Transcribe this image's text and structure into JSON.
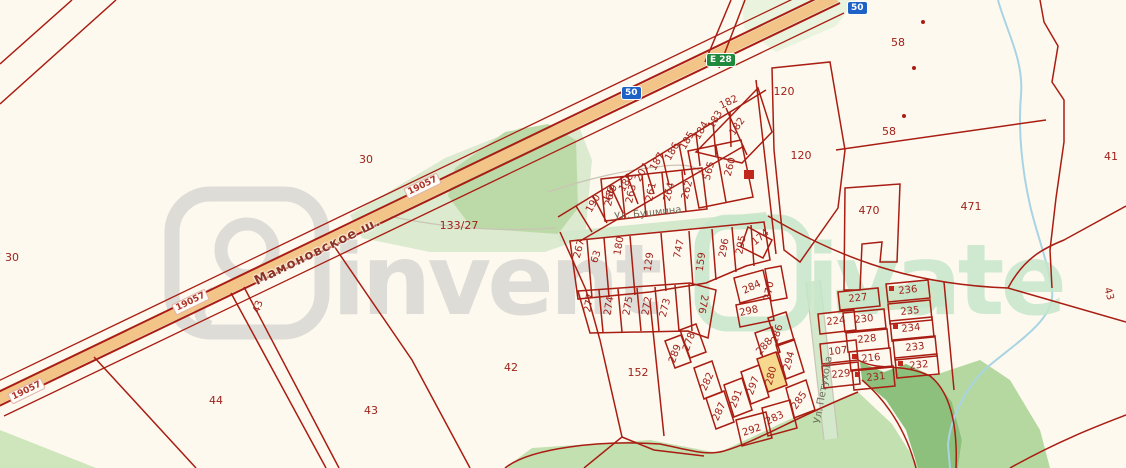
{
  "roads": {
    "highway_name": "Мамоновское ш.",
    "route_badge": "E 28",
    "km_post": "19057",
    "speed_badge": "50"
  },
  "streets": {
    "bushmina": "Ул. Бушмина",
    "petukhova": "Ул. Петухова"
  },
  "watermark": {
    "brand_left": "invent",
    "brand_right": "ivate"
  },
  "labels": {
    "p30_left": "30",
    "p30_mid": "30",
    "p133_27": "133/27",
    "p44": "44",
    "p43_strip": "43",
    "p43_bottom": "43",
    "p42": "42",
    "p152": "152",
    "p58_top": "58",
    "p58_mid": "58",
    "p41": "41",
    "p43_right": "43",
    "p120_top": "120",
    "p120_bottom": "120",
    "p470": "470",
    "p471": "471",
    "p190": "190",
    "p189": "189",
    "p188": "188",
    "p207": "207",
    "p187": "187",
    "p186": "186",
    "p185": "185",
    "p184": "184",
    "p183": "183",
    "p182_top": "182",
    "p182_side": "182",
    "p565": "565",
    "p260": "260",
    "p266": "266",
    "p263": "263",
    "p261": "261",
    "p264": "264",
    "p262": "262",
    "p267": "267",
    "p63": "63",
    "p180": "180",
    "p129": "129",
    "p747": "747",
    "p159": "159",
    "p296": "296",
    "p295": "295",
    "p174": "174",
    "p277": "277",
    "p274": "274",
    "p275": "275",
    "p272": "272",
    "p273": "273",
    "p276": "276",
    "p284": "284",
    "p270": "270",
    "p298": "298",
    "p286": "286",
    "p288": "288",
    "p294": "294",
    "p280": "280",
    "p297": "297",
    "p291": "291",
    "p282": "282",
    "p287": "287",
    "p292": "292",
    "p283": "283",
    "p285": "285",
    "p278": "278",
    "p289": "289",
    "p227": "227",
    "p236": "236",
    "p224": "224",
    "p230": "230",
    "p235": "235",
    "p228": "228",
    "p234": "234",
    "p107": "107",
    "p216": "216",
    "p233": "233",
    "p229": "229",
    "p231": "231",
    "p232": "232"
  }
}
